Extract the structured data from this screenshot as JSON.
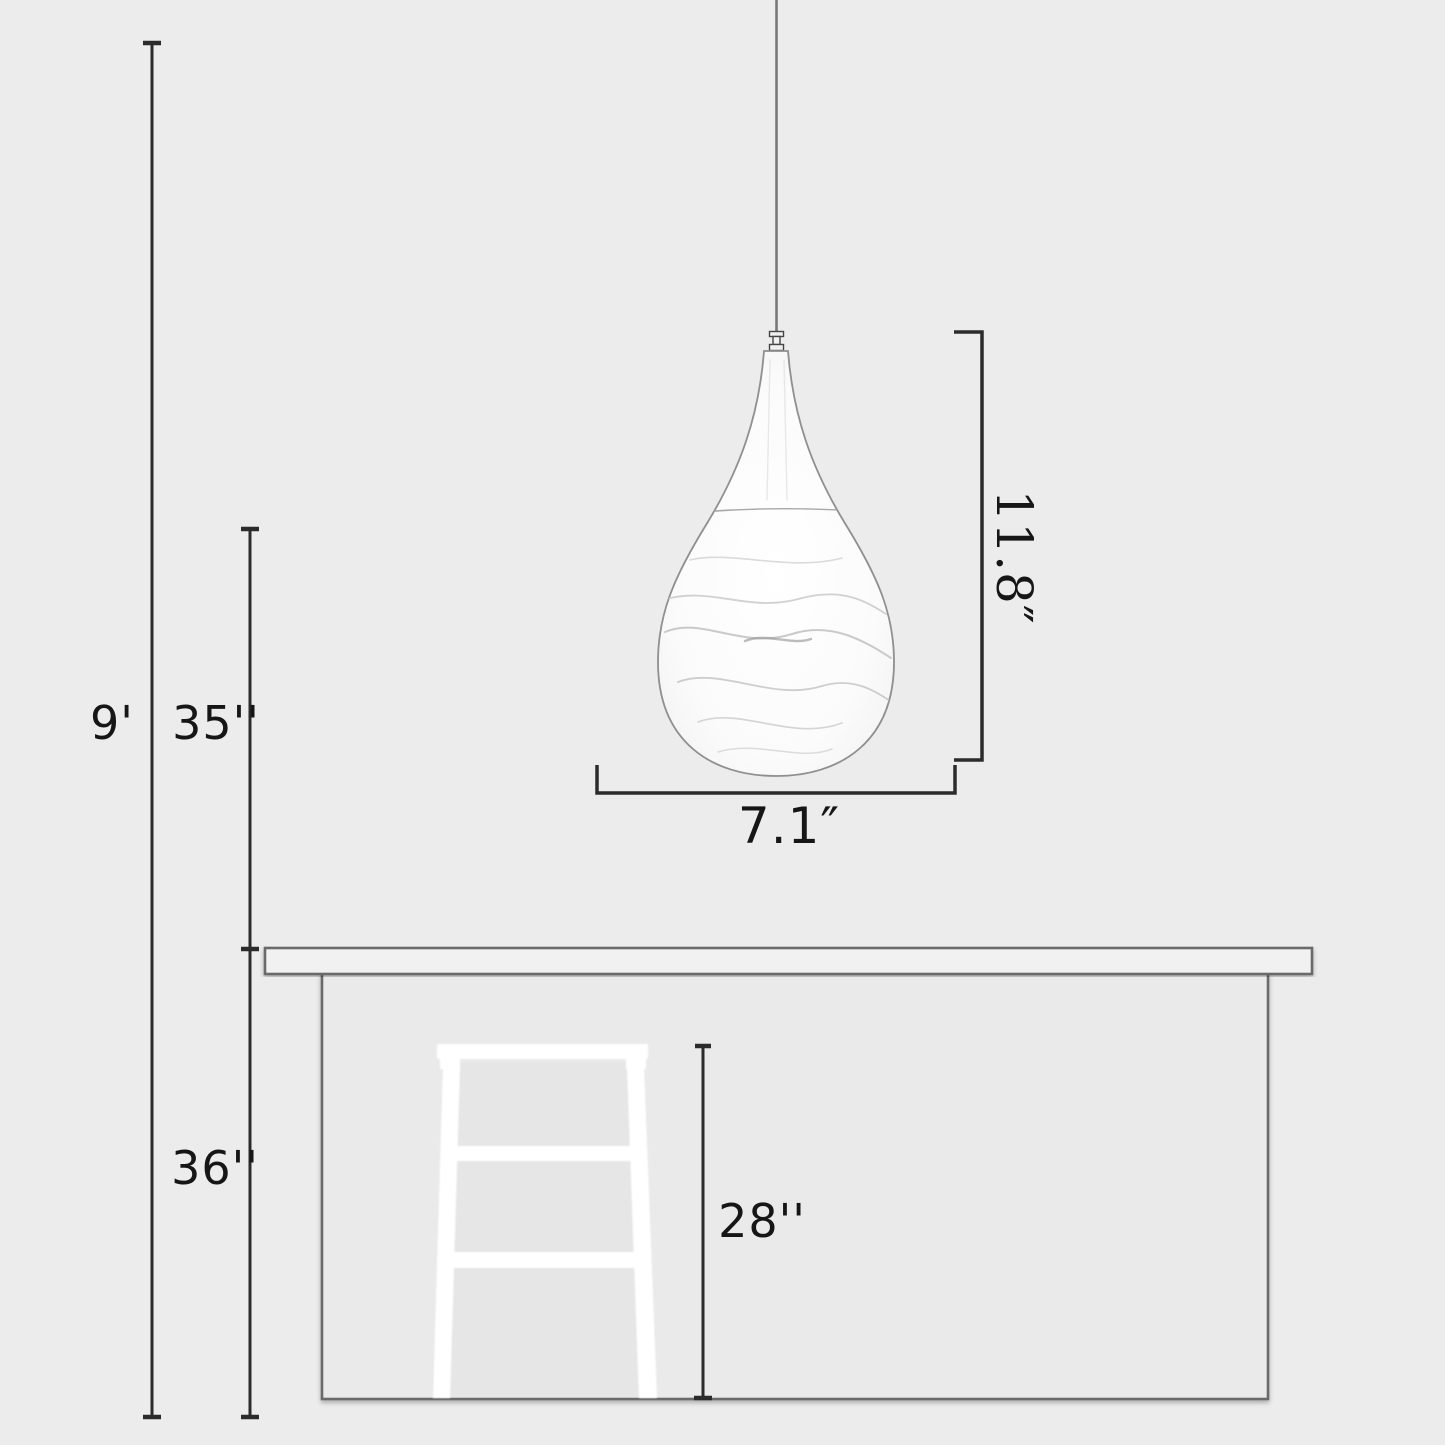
{
  "diagram": {
    "type": "pendant-light-dimension-diagram",
    "background": "#ececec",
    "colors": {
      "dimension_line": "#2b2b2b",
      "label_text": "#161616",
      "counter_outline": "#6b6b6b",
      "counter_top_fill": "#f1f1f1",
      "counter_body_fill": "#eaeaea",
      "lamp_outline": "#8f8f8f",
      "lamp_fill": "#fdfdfd",
      "cord_color": "#787878",
      "stool_fill": "#ffffff"
    },
    "labels": {
      "ceiling_drop": "9'",
      "lamp_bottom_to_counter": "35''",
      "counter_height": "36''",
      "stool_height": "28''",
      "shade_height": "11.8″",
      "shade_width": "7.1″"
    }
  }
}
